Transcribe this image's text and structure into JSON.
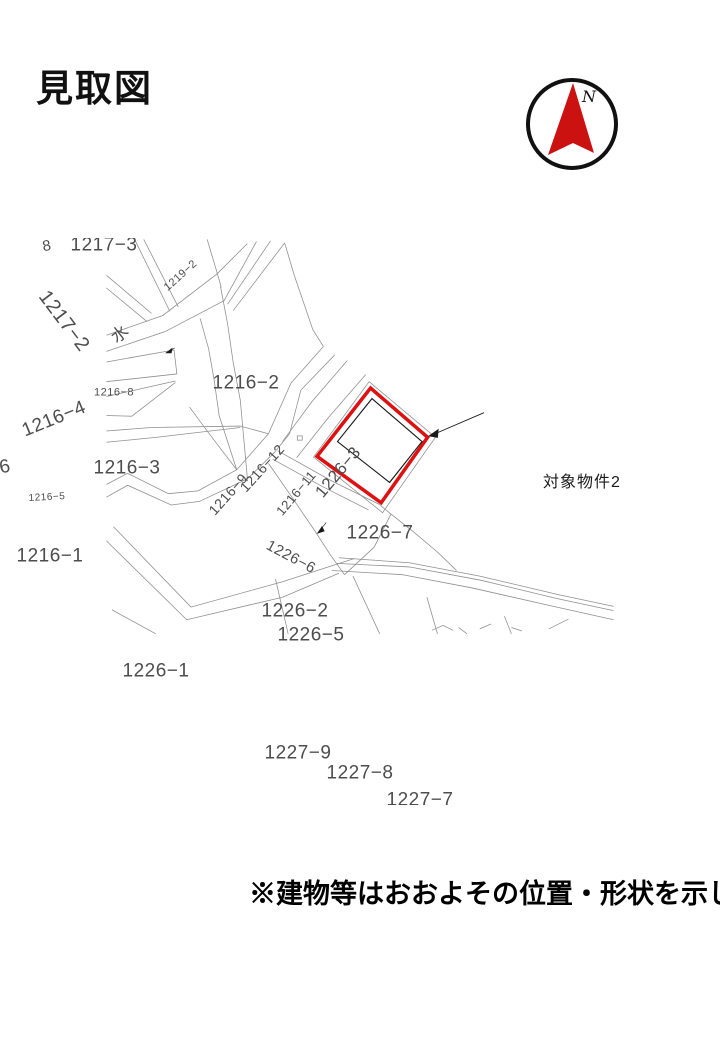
{
  "title": "見取図",
  "compass": {
    "label": "N"
  },
  "note": "※建物等はおおよその位置・形状を示している。",
  "colors": {
    "highlight": "#dd1111",
    "parcel_line": "#8f8f8f",
    "parcel_label": "#4d4d4d",
    "needle": "#cc1111"
  },
  "map": {
    "highlighted_parcel": "1226−7",
    "target_annotation": "対象物件2",
    "labels": [
      {
        "text": "1217−3"
      },
      {
        "text": "8"
      },
      {
        "text": "1219−2"
      },
      {
        "text": "1217−2"
      },
      {
        "text": "水"
      },
      {
        "text": "1216−2"
      },
      {
        "text": "1216−8"
      },
      {
        "text": "1216−4"
      },
      {
        "text": "6"
      },
      {
        "text": "1216−3"
      },
      {
        "text": "1216−5"
      },
      {
        "text": "1216−12"
      },
      {
        "text": "1216−9"
      },
      {
        "text": "1216−11"
      },
      {
        "text": "1226−3"
      },
      {
        "text": "1226−6"
      },
      {
        "text": "1226−7"
      },
      {
        "text": "対象物件2"
      },
      {
        "text": "1226−2"
      },
      {
        "text": "1226−5"
      },
      {
        "text": "1216−1"
      },
      {
        "text": "1226−1"
      },
      {
        "text": "1227−9"
      },
      {
        "text": "1227−8"
      },
      {
        "text": "1227−7"
      }
    ]
  }
}
